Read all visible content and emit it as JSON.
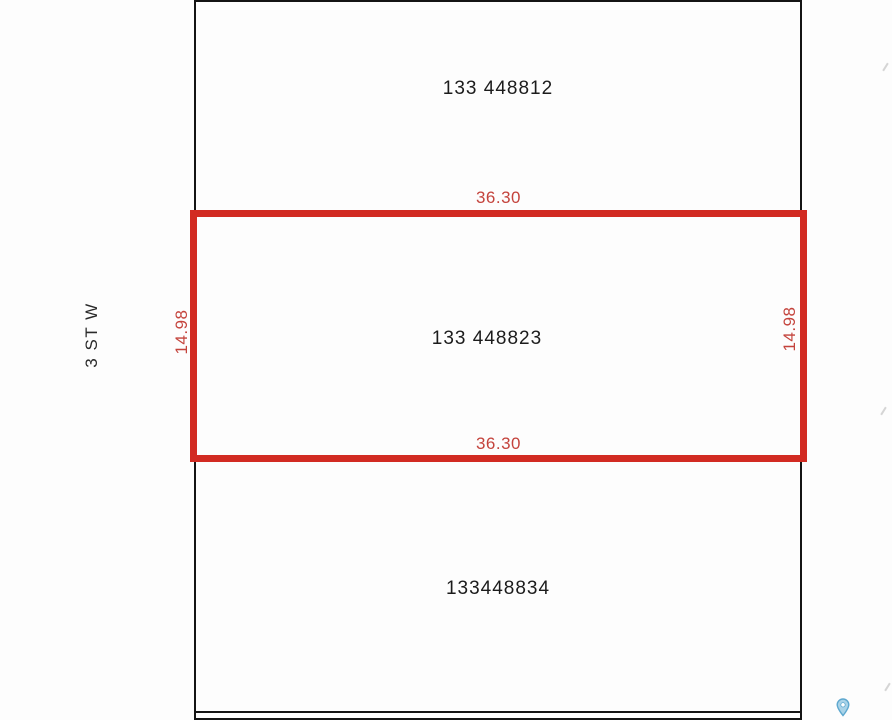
{
  "map": {
    "street_label": "3 ST W",
    "parcels": [
      {
        "id": "133 448812",
        "position": "north",
        "selected": false
      },
      {
        "id": "133 448823",
        "position": "center",
        "selected": true
      },
      {
        "id": "133448834",
        "position": "south",
        "selected": false
      }
    ],
    "selected_parcel": {
      "id": "133 448823",
      "dimensions": {
        "top": "36.30",
        "bottom": "36.30",
        "left": "14.98",
        "right": "14.98"
      }
    },
    "icons": {
      "map_pin": "map-pin-icon"
    },
    "colors": {
      "selection_red": "#d22b22",
      "dimension_text_red": "#c4433c",
      "boundary_black": "#141414",
      "pin_blue": "#6fb4d6",
      "background": "#fdfdfd"
    }
  }
}
